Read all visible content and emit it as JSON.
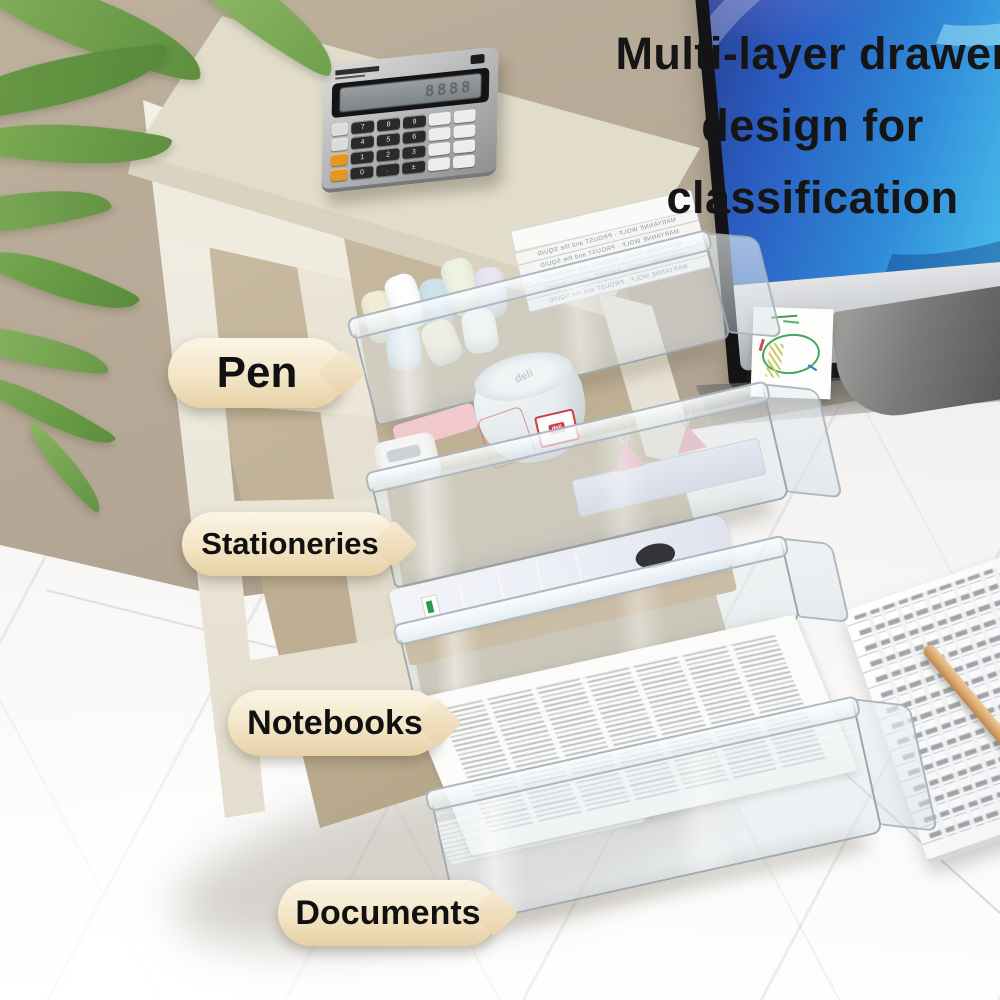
{
  "headline": {
    "line1": "Multi-layer drawer",
    "line2": "design for",
    "line3": "classification",
    "color": "#151515"
  },
  "labels": [
    {
      "text": "Pen"
    },
    {
      "text": "Stationeries"
    },
    {
      "text": "Notebooks"
    },
    {
      "text": "Documents"
    }
  ],
  "label_style": {
    "bg_top": "#fbf5e6",
    "bg_bottom": "#e7d0a6",
    "text_color": "#111111"
  },
  "drawers": [
    {
      "label": "Pen",
      "book_spine": "MARYANNE WOLF · PROUST and the SQUID"
    },
    {
      "label": "Stationeries",
      "canister_brand": "deli"
    },
    {
      "label": "Notebooks"
    },
    {
      "label": "Documents"
    }
  ],
  "calculator": {
    "lcd_digits": "8888",
    "keys": [
      "7",
      "8",
      "9",
      "4",
      "5",
      "6",
      "1",
      "2",
      "3",
      "0",
      ".",
      "±"
    ]
  },
  "monitor": {
    "wallpaper_colors": [
      "#24357e",
      "#2b5cc0",
      "#45b4e8",
      "#7fd4f2",
      "#8a7fd8"
    ],
    "chin_color": "#c7cacd",
    "logo": "apple-logo"
  },
  "scene": {
    "wall_color": "#b3a593",
    "desk_color": "#f4f2f0"
  }
}
